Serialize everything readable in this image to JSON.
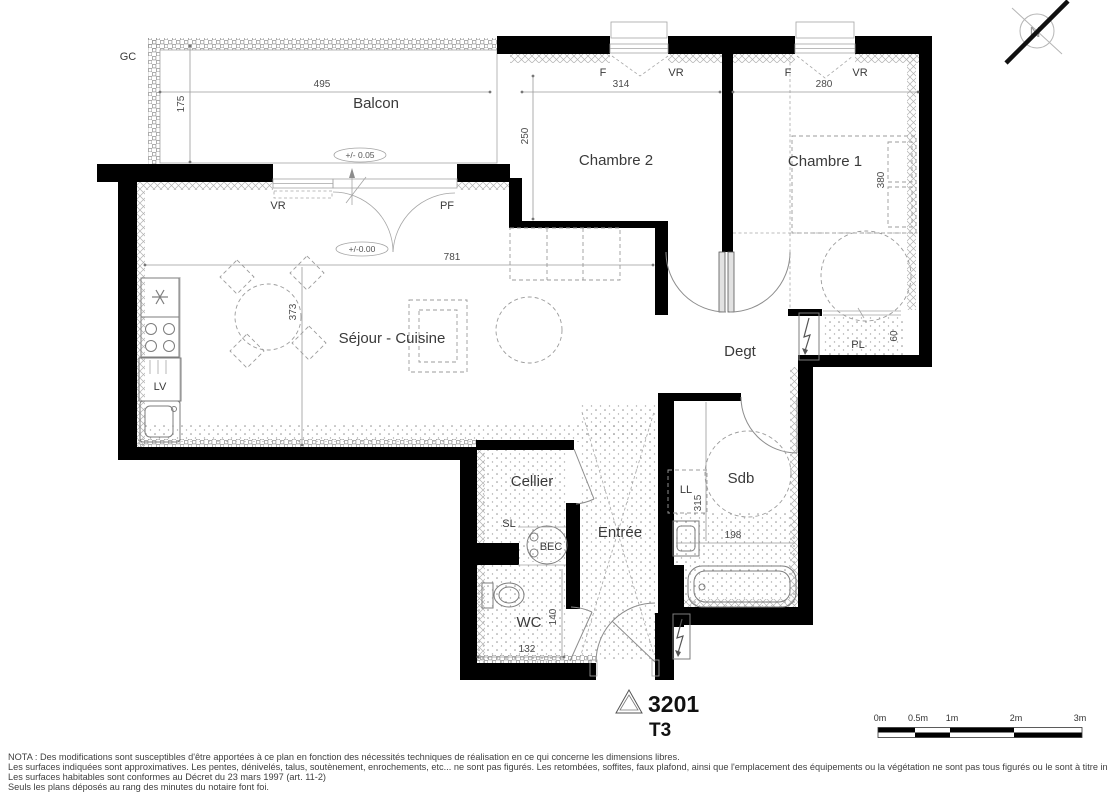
{
  "title_block": {
    "lot": "3201",
    "type": "T3"
  },
  "compass": {
    "north": "N"
  },
  "balcony": {
    "label": "Balcon",
    "gc_label": "GC",
    "width_dim": "495",
    "depth_dim": "175",
    "level": "+/- 0.05"
  },
  "living": {
    "label": "Séjour - Cuisine",
    "width_dim": "781",
    "depth_dim": "373",
    "level": "+/-0.00",
    "vr_label": "VR",
    "pf_label": "PF",
    "dishwasher_label": "LV"
  },
  "bedroom2": {
    "label": "Chambre 2",
    "width_dim": "314",
    "depth_dim": "250",
    "f_label": "F",
    "vr_label": "VR"
  },
  "bedroom1": {
    "label": "Chambre 1",
    "width_dim": "280",
    "depth_dim": "380",
    "f_label": "F",
    "vr_label": "VR"
  },
  "hallway": {
    "label": "Degt"
  },
  "closet": {
    "label": "PL",
    "depth_dim": "60"
  },
  "bathroom": {
    "label": "Sdb",
    "washer_label": "LL",
    "depth_dim": "315",
    "width_dim": "198"
  },
  "storage": {
    "label": "Cellier",
    "sl_label": "SL",
    "heater_label": "BEC"
  },
  "entry": {
    "label": "Entrée"
  },
  "wc": {
    "label": "WC",
    "width_dim": "132",
    "depth_dim": "140"
  },
  "scale_bar": {
    "labels": [
      "0m",
      "0.5m",
      "1m",
      "2m",
      "3m"
    ]
  },
  "nota": {
    "lines": [
      "NOTA : Des modifications sont susceptibles d'être apportées à ce plan en fonction des nécessités techniques de réalisation en ce qui concerne les dimensions libres.",
      "Les surfaces indiquées sont approximatives. Les pentes, dénivelés, talus, soutènement, enrochements, etc... ne sont pas figurés. Les retombées, soffites, faux plafond, ainsi que l'emplacement des équipements ou la végétation ne sont pas tous figurés ou le sont à titre indicatif.",
      "Les surfaces habitables sont conformes au Décret du 23 mars 1997 (art. 11-2)",
      "Seuls les plans déposés au rang des minutes du notaire font foi."
    ]
  },
  "colors": {
    "wall": "#000000",
    "line": "#8c8c8c",
    "text": "#3a3a3a"
  }
}
